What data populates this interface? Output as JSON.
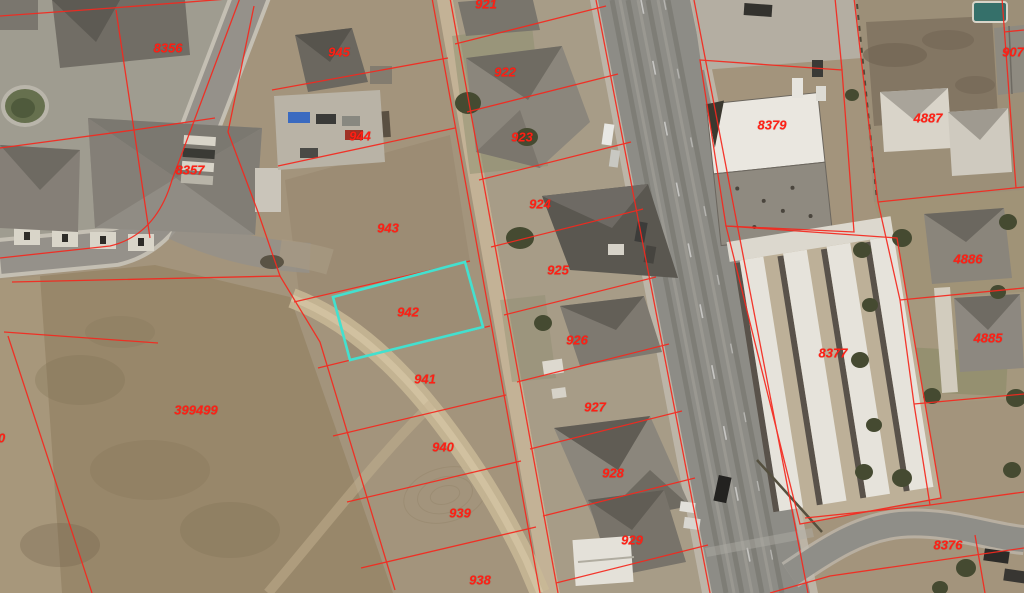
{
  "map": {
    "type": "aerial-parcel-map",
    "highlighted_parcel": "942",
    "colors": {
      "parcel_line": "#f5281e",
      "parcel_label": "#ff1f14",
      "highlight": "#43e0cf"
    },
    "parcel_labels": [
      {
        "label": "8356",
        "x": 168,
        "y": 48
      },
      {
        "label": "8357",
        "x": 190,
        "y": 170
      },
      {
        "label": "399499",
        "x": 196,
        "y": 410
      },
      {
        "label": "945",
        "x": 339,
        "y": 52
      },
      {
        "label": "944",
        "x": 360,
        "y": 136
      },
      {
        "label": "943",
        "x": 388,
        "y": 228
      },
      {
        "label": "942",
        "x": 408,
        "y": 312
      },
      {
        "label": "941",
        "x": 425,
        "y": 379
      },
      {
        "label": "940",
        "x": 443,
        "y": 447
      },
      {
        "label": "939",
        "x": 460,
        "y": 513
      },
      {
        "label": "938",
        "x": 480,
        "y": 580
      },
      {
        "label": "921",
        "x": 486,
        "y": 4
      },
      {
        "label": "922",
        "x": 505,
        "y": 72
      },
      {
        "label": "923",
        "x": 522,
        "y": 137
      },
      {
        "label": "924",
        "x": 540,
        "y": 204
      },
      {
        "label": "925",
        "x": 558,
        "y": 270
      },
      {
        "label": "926",
        "x": 577,
        "y": 340
      },
      {
        "label": "927",
        "x": 595,
        "y": 407
      },
      {
        "label": "928",
        "x": 613,
        "y": 473
      },
      {
        "label": "929",
        "x": 632,
        "y": 540
      },
      {
        "label": "8379",
        "x": 772,
        "y": 125
      },
      {
        "label": "8377",
        "x": 833,
        "y": 353
      },
      {
        "label": "8376",
        "x": 948,
        "y": 545
      },
      {
        "label": "4887",
        "x": 928,
        "y": 118
      },
      {
        "label": "4886",
        "x": 968,
        "y": 259
      },
      {
        "label": "4885",
        "x": 988,
        "y": 338
      },
      {
        "label": "907",
        "x": 1013,
        "y": 52
      },
      {
        "label": "90",
        "x": -2,
        "y": 438
      }
    ]
  }
}
